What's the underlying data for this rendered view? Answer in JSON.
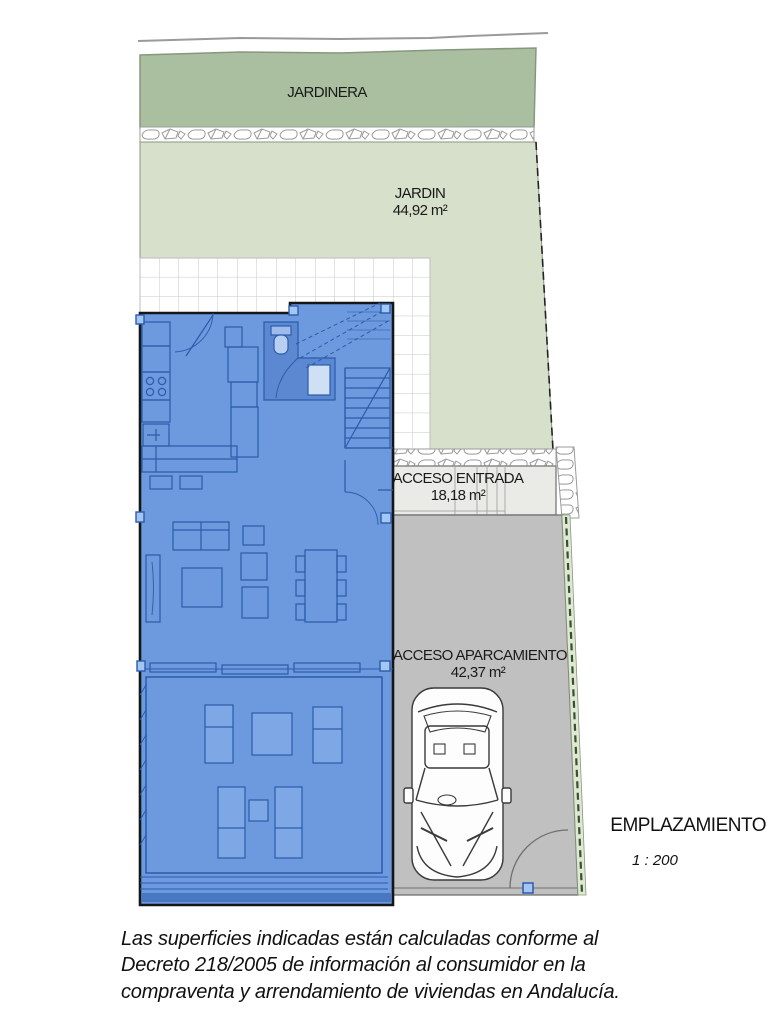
{
  "plan": {
    "title": "EMPLAZAMIENTO",
    "scale": "1 : 200",
    "zones": {
      "jardinera": {
        "label": "JARDINERA"
      },
      "jardin": {
        "label": "JARDIN",
        "area": "44,92 m²"
      },
      "acceso_entrada": {
        "label": "ACCESO ENTRADA",
        "area": "18,18 m²"
      },
      "acceso_aparcamiento": {
        "label": "ACCESO APARCAMIENTO",
        "area": "42,37 m²"
      }
    }
  },
  "footer": {
    "lines": [
      "Las superficies indicadas están calculadas conforme al",
      "Decreto 218/2005 de información al consumidor en la",
      "compraventa y arrendamiento de viviendas en Andalucía."
    ]
  },
  "colors": {
    "jardinera": "#a9bfa0",
    "jardin": "#d7e0ca",
    "green_line": "#87977f",
    "hedge": "#dfe8d2",
    "hedge_dash": "#35522f",
    "tile_line": "#c7c7c7",
    "stone_line": "#9b9b9b",
    "entrance": "#eaeae7",
    "parking": "#c0c0c0",
    "house_fill": "#6d99de",
    "house_line": "#2b5cab",
    "house_dark": "#5b88d0",
    "furniture": "#7ea7e6",
    "marker": "#a3c6f2",
    "outline": "#161616",
    "boundary_gray": "#9a9a9a"
  }
}
